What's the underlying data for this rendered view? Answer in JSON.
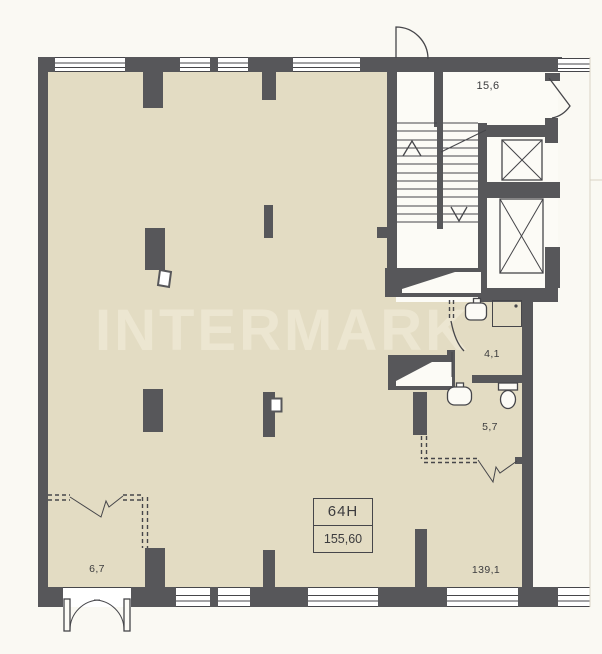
{
  "watermark_text": "INTERMARK",
  "unit_box": {
    "number": "64Н",
    "area_total": "155,60"
  },
  "rooms": [
    {
      "id": "elevator-hall",
      "area_label": "15,6"
    },
    {
      "id": "shower-room",
      "area_label": "4,1"
    },
    {
      "id": "wc",
      "area_label": "5,7"
    },
    {
      "id": "entry-vestibule",
      "area_label": "6,7"
    },
    {
      "id": "main-space",
      "area_label": "139,1"
    }
  ],
  "colors": {
    "bg": "#faf9f3",
    "floor": "#e3dcc3",
    "wall": "#57575a",
    "line": "#46464a",
    "winw": "#ffffff",
    "intw": "#fcfbf6",
    "wm": "#ece6d1",
    "txt": "#3c3c3e",
    "frame": "#d9d4c4"
  }
}
